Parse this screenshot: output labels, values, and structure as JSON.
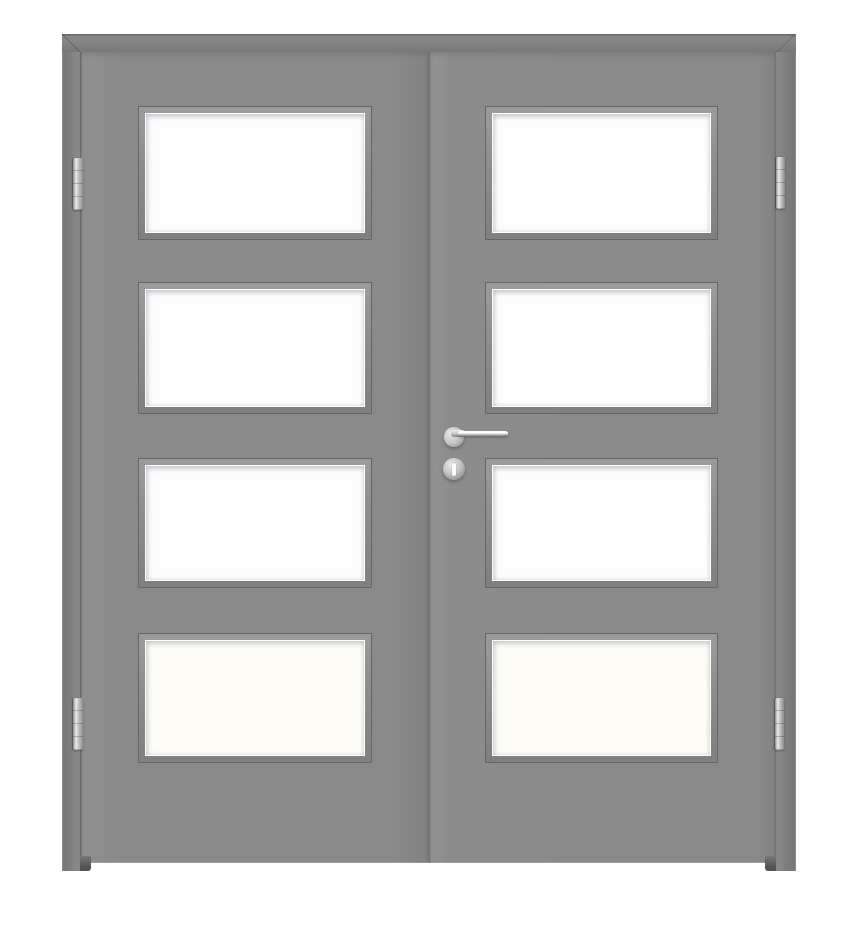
{
  "scene": {
    "type": "product-photo",
    "description": "Gray double interior door, two leaves each with four rectangular glass lites, silver hinges, lever handle and keyhole",
    "text_content": "none"
  },
  "door": {
    "leaves": [
      {
        "side": "left"
      },
      {
        "side": "right"
      }
    ],
    "lites_per_leaf": 4,
    "hinges": [
      {
        "position": "left-top"
      },
      {
        "position": "left-bottom"
      },
      {
        "position": "right-top"
      },
      {
        "position": "right-bottom"
      }
    ],
    "hardware": {
      "lever_handle": "silver lever on right leaf pointing right",
      "keyhole": "round escutcheon below handle"
    }
  },
  "colors": {
    "background": "#ffffff",
    "frame": "#7e7e7e",
    "leaf": "#8a8a8a",
    "leaf_seam": "#6f6f6f",
    "bead": "#8e8e8e",
    "bead_outline": "#656565",
    "glass": "#fdfdfe",
    "glass_warm": "#fdfcf7",
    "metal_light": "#e9e9e9",
    "metal_mid": "#c4c4c4",
    "metal_dark": "#8d8d8d"
  }
}
